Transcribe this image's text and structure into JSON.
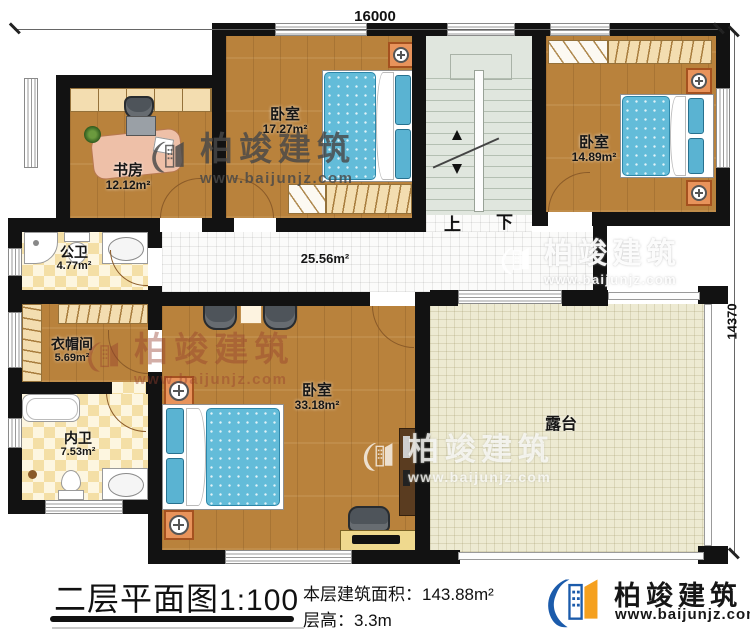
{
  "plan": {
    "dimension_width": "16000",
    "dimension_height": "14370"
  },
  "rooms": {
    "study": {
      "name": "书房",
      "area": "12.12m²"
    },
    "bedroom_top": {
      "name": "卧室",
      "area": "17.27m²"
    },
    "bedroom_right": {
      "name": "卧室",
      "area": "14.89m²"
    },
    "master_bedroom": {
      "name": "卧室",
      "area": "33.18m²"
    },
    "public_bath": {
      "name": "公卫",
      "area": "4.77m²"
    },
    "cloakroom": {
      "name": "衣帽间",
      "area": "5.69m²"
    },
    "ensuite_bath": {
      "name": "内卫",
      "area": "7.53m²"
    },
    "corridor": {
      "area": "25.56m²"
    },
    "terrace": {
      "name": "露台"
    }
  },
  "stairs": {
    "up_label": "上",
    "down_label": "下"
  },
  "footer": {
    "title": "二层平面图",
    "scale": "1:100",
    "area_label": "本层建筑面积：",
    "area_value": "143.88m²",
    "floor_height_label": "层高：",
    "floor_height_value": "3.3m"
  },
  "brand": {
    "name": "柏竣建筑",
    "website": "www.baijunjz.com"
  },
  "colors": {
    "wall": "#121212",
    "brand_blue": "#1b5bab",
    "brand_orange": "#f5a01e",
    "bed_blue": "#63bcd9",
    "wood_floor": "#b9823c",
    "terrace_floor": "#edead2"
  }
}
